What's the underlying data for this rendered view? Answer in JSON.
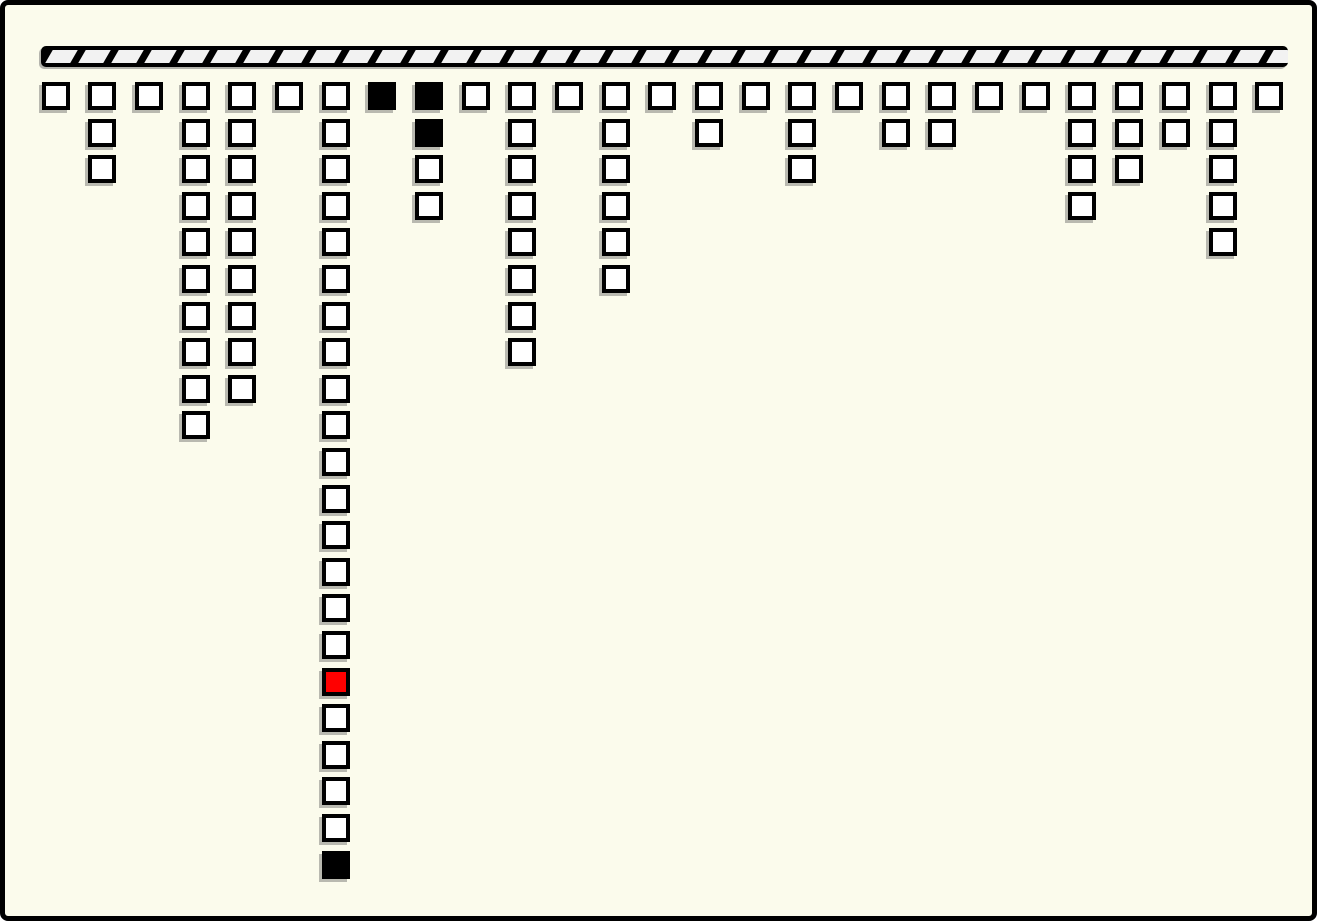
{
  "canvas": {
    "background_color": "#FBFBEC",
    "frame_color": "#000000"
  },
  "ceiling_bar": {
    "segments": 38,
    "bar_color": "#000000",
    "hatch_color": "#F2F2F2"
  },
  "cell_colors": {
    "white": "#FFFFFF",
    "black": "#000000",
    "red": "#FF0000"
  },
  "grid": {
    "column_count": 27,
    "total_cells": 97,
    "highlight": {
      "column": 7,
      "row": 17,
      "color": "red"
    },
    "filled_black": [
      {
        "column": 7,
        "row": 22
      },
      {
        "column": 8,
        "row": 1
      },
      {
        "column": 9,
        "row": 1
      },
      {
        "column": 9,
        "row": 2
      }
    ],
    "columns": [
      {
        "index": 1,
        "cells": [
          "white"
        ]
      },
      {
        "index": 2,
        "cells": [
          "white",
          "white",
          "white"
        ]
      },
      {
        "index": 3,
        "cells": [
          "white"
        ]
      },
      {
        "index": 4,
        "cells": [
          "white",
          "white",
          "white",
          "white",
          "white",
          "white",
          "white",
          "white",
          "white",
          "white"
        ]
      },
      {
        "index": 5,
        "cells": [
          "white",
          "white",
          "white",
          "white",
          "white",
          "white",
          "white",
          "white",
          "white"
        ]
      },
      {
        "index": 6,
        "cells": [
          "white"
        ]
      },
      {
        "index": 7,
        "cells": [
          "white",
          "white",
          "white",
          "white",
          "white",
          "white",
          "white",
          "white",
          "white",
          "white",
          "white",
          "white",
          "white",
          "white",
          "white",
          "white",
          "red",
          "white",
          "white",
          "white",
          "white",
          "black"
        ]
      },
      {
        "index": 8,
        "cells": [
          "black"
        ]
      },
      {
        "index": 9,
        "cells": [
          "black",
          "black",
          "white",
          "white"
        ]
      },
      {
        "index": 10,
        "cells": [
          "white"
        ]
      },
      {
        "index": 11,
        "cells": [
          "white",
          "white",
          "white",
          "white",
          "white",
          "white",
          "white",
          "white"
        ]
      },
      {
        "index": 12,
        "cells": [
          "white"
        ]
      },
      {
        "index": 13,
        "cells": [
          "white",
          "white",
          "white",
          "white",
          "white",
          "white"
        ]
      },
      {
        "index": 14,
        "cells": [
          "white"
        ]
      },
      {
        "index": 15,
        "cells": [
          "white",
          "white"
        ]
      },
      {
        "index": 16,
        "cells": [
          "white"
        ]
      },
      {
        "index": 17,
        "cells": [
          "white",
          "white",
          "white"
        ]
      },
      {
        "index": 18,
        "cells": [
          "white"
        ]
      },
      {
        "index": 19,
        "cells": [
          "white",
          "white"
        ]
      },
      {
        "index": 20,
        "cells": [
          "white",
          "white"
        ]
      },
      {
        "index": 21,
        "cells": [
          "white"
        ]
      },
      {
        "index": 22,
        "cells": [
          "white"
        ]
      },
      {
        "index": 23,
        "cells": [
          "white",
          "white",
          "white",
          "white"
        ]
      },
      {
        "index": 24,
        "cells": [
          "white",
          "white",
          "white"
        ]
      },
      {
        "index": 25,
        "cells": [
          "white",
          "white"
        ]
      },
      {
        "index": 26,
        "cells": [
          "white",
          "white",
          "white",
          "white",
          "white"
        ]
      },
      {
        "index": 27,
        "cells": [
          "white"
        ]
      }
    ]
  }
}
